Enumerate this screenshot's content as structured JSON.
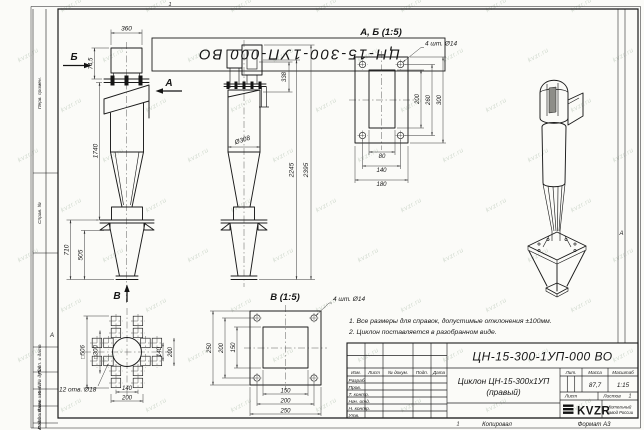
{
  "page": {
    "watermark": "kvzr.ru",
    "copied_label": "Копировал",
    "format_note": "Формат А3",
    "sheet_mark": "1"
  },
  "frame": {
    "corner_doc_number": "ЦН-15-300-1УП-000 ВО",
    "zone_letter": "А",
    "left_strip": [
      "Перв. примен.",
      "Справ. №",
      "Подп. и дата",
      "Инв. № дубл.",
      "Взам. инв. №",
      "Подп. и дата",
      "Инв. № подл."
    ]
  },
  "views": {
    "front": {
      "label_b": "Б",
      "label_a": "А",
      "label_v": "В",
      "dim_top_width": "360",
      "dim_inlet_height": "74,5",
      "dim_body_height": "1740",
      "dim_support_height": "710",
      "dim_hopper_height": "505"
    },
    "side": {
      "dim_outlet": "338",
      "dim_diameter": "Ø308",
      "dim_height_inner": "2245",
      "dim_height_total": "2395"
    },
    "flange_ab": {
      "title": "А, Б (1:5)",
      "holes_note": "4 шт. Ø14",
      "dim_v": [
        "200",
        "260",
        "300"
      ],
      "dim_h": [
        "80",
        "140",
        "180"
      ]
    },
    "flange_v": {
      "title": "В (1:5)",
      "holes_note": "4 шт. Ø14",
      "dim_v": [
        "150",
        "200",
        "250"
      ],
      "dim_h": [
        "150",
        "200",
        "250"
      ]
    },
    "base": {
      "dim_outer": "□506",
      "dim_inner": "□300",
      "holes_note": "12 отв. Ø18",
      "dim_right": [
        "140",
        "200"
      ],
      "dim_bottom": [
        "140",
        "200"
      ]
    }
  },
  "notes": [
    "1. Все размеры для справок, допустимые отклонения ±100мм.",
    "2. Циклон поставляется в разобранном виде."
  ],
  "title_block": {
    "doc_number": "ЦН-15-300-1УП-000 ВО",
    "product_name_line1": "Циклон ЦН-15-300х1УП",
    "product_name_line2": "(правый)",
    "header_cols": [
      "Изм.",
      "Лист",
      "№ докум.",
      "Подп.",
      "Дата"
    ],
    "staff_rows": [
      "Разраб.",
      "Пров.",
      "Т. контр.",
      "Нач. отд.",
      "Н. контр.",
      "Утв."
    ],
    "lit_label": "Лит.",
    "mass_label": "Масса",
    "scale_label": "Масштаб",
    "mass_value": "87,7",
    "scale_value": "1:15",
    "sheet_label": "Лист",
    "sheets_label": "Листов",
    "sheets_value": "1",
    "logo_text": "KVZR",
    "company_line1": "Котельный",
    "company_line2": "завод России"
  }
}
